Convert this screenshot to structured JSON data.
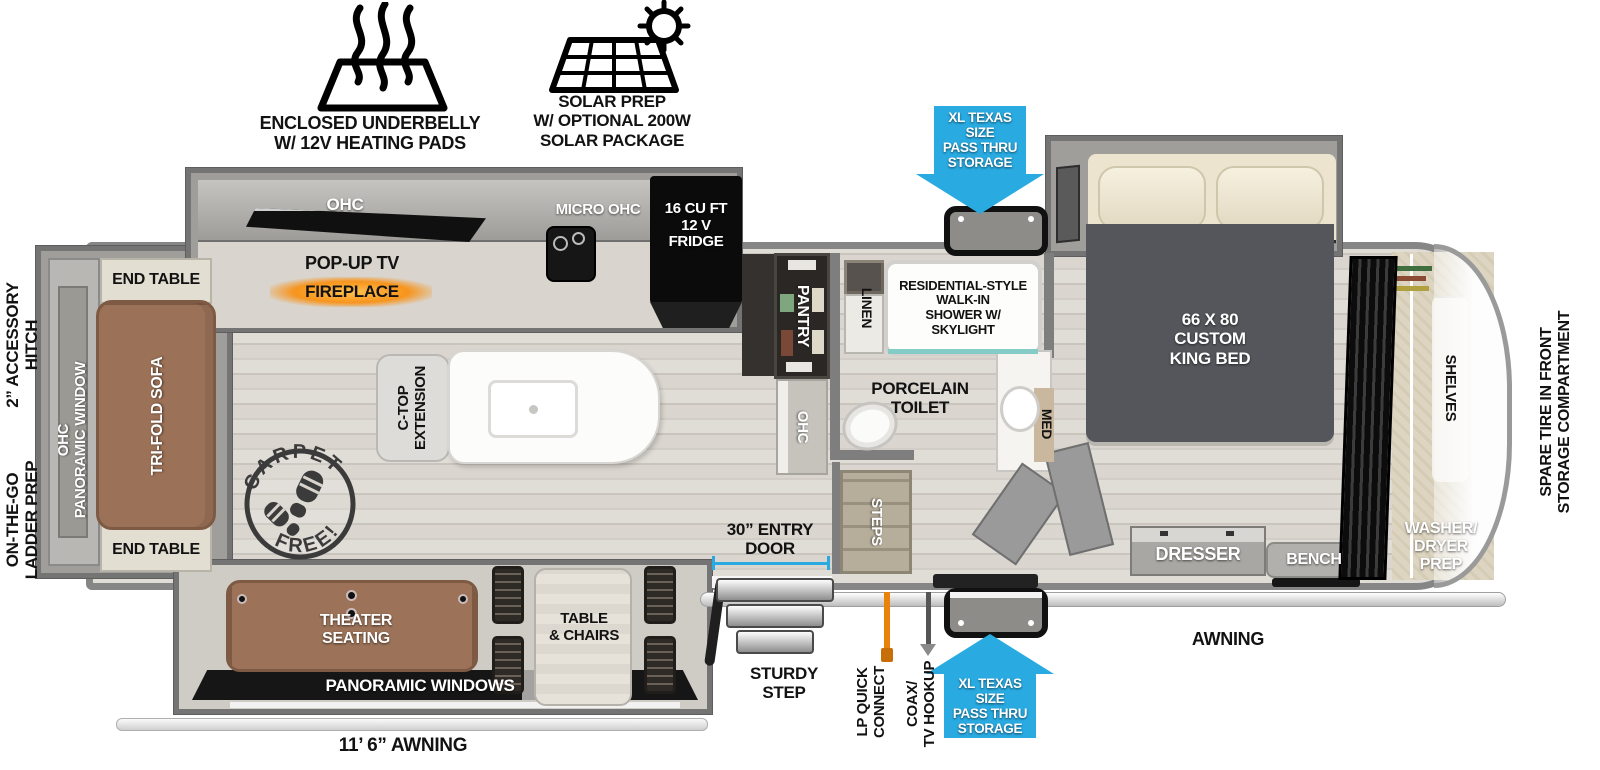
{
  "colors": {
    "accent_blue": "#29ABE2",
    "fireplace_orange": "#F7941D",
    "sofa_brown": "#9B7157",
    "wall_gray": "#868686",
    "floor": "#D8D3CC",
    "fridge_black": "#0B0B0B"
  },
  "features": {
    "underbelly": "ENCLOSED UNDERBELLY\nW/ 12V HEATING PADS",
    "solar": "SOLAR PREP\nW/ OPTIONAL 200W\nSOLAR PACKAGE"
  },
  "exterior": {
    "pass_thru_top": "XL TEXAS SIZE\nPASS THRU\nSTORAGE",
    "pass_thru_bottom": "XL TEXAS SIZE\nPASS THRU\nSTORAGE",
    "accessory_hitch": "2” ACCESSORY\nHITCH",
    "ladder_prep": "ON-THE-GO\nLADDER PREP",
    "spare_tire": "SPARE TIRE IN FRONT\nSTORAGE COMPARTMENT",
    "entry_door": "30” ENTRY\nDOOR",
    "sturdy_step": "STURDY\nSTEP",
    "lp_quick_connect": "LP QUICK\nCONNECT",
    "coax_tv": "COAX/\nTV HOOKUP",
    "awning": "AWNING",
    "awning_size": "11’ 6” AWNING"
  },
  "rear_lounge": {
    "end_table_top": "END TABLE",
    "end_table_bottom": "END TABLE",
    "sofa": "TRI-FOLD SOFA",
    "window": "OHC\nPANORAMIC WINDOW"
  },
  "living": {
    "ohc": "OHC",
    "pop_up_tv": "POP-UP TV",
    "fireplace": "FIREPLACE",
    "ctop_extension": "C-TOP\nEXTENSION",
    "carpet_stamp_top": "CARPET",
    "carpet_stamp_bottom": "FREE!",
    "theater_seating": "THEATER\nSEATING",
    "table_chairs": "TABLE\n& CHAIRS",
    "panoramic_windows": "PANORAMIC WINDOWS"
  },
  "kitchen": {
    "micro_ohc": "MICRO  OHC",
    "fridge": "16 CU FT\n12 V\nFRIDGE",
    "pantry": "PANTRY",
    "ohc_counter": "OHC"
  },
  "bath": {
    "linen": "LINEN",
    "shower": "RESIDENTIAL-STYLE\nWALK-IN\nSHOWER W/\nSKYLIGHT",
    "toilet": "PORCELAIN\nTOILET",
    "med": "MED",
    "steps": "STEPS"
  },
  "bedroom": {
    "bed": "66 X  80\nCUSTOM\nKING BED",
    "dresser": "DRESSER",
    "bench": "BENCH"
  },
  "front_storage": {
    "shelves": "SHELVES",
    "washer_dryer": "WASHER/\nDRYER\nPREP"
  }
}
